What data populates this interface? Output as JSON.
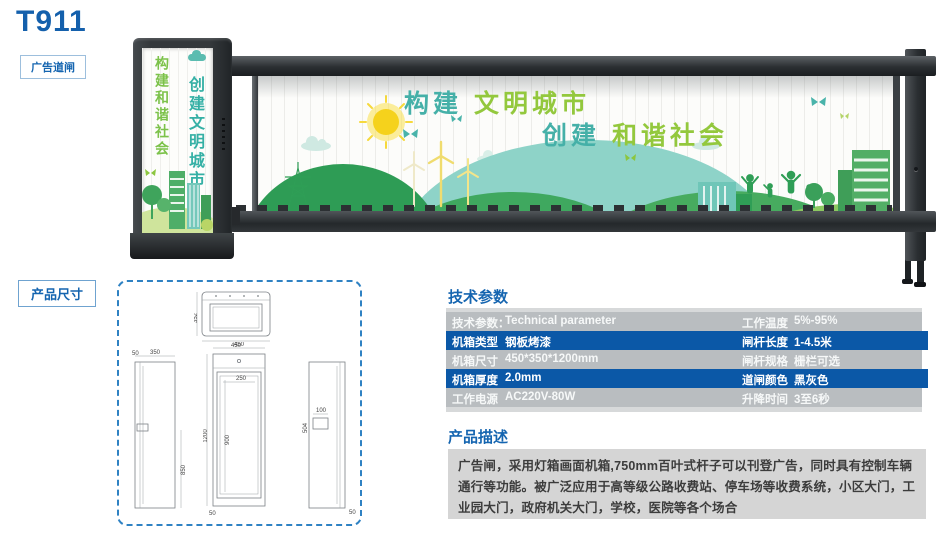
{
  "header": {
    "model": "T911",
    "tag": "广告道闸"
  },
  "figure": {
    "cabinet_col_left": "构建和谐社会",
    "cabinet_col_right": "创建文明城市",
    "banner": {
      "line1_a": "构建",
      "line1_b": "文明城市",
      "line2_a": "创建",
      "line2_b": "和谐社会"
    }
  },
  "dims": {
    "label": "产品尺寸",
    "top_view": {
      "depth": "352",
      "width": "450"
    },
    "side_left": {
      "offset": "50",
      "depth": "350",
      "lower_height": "850"
    },
    "front": {
      "width": "450",
      "height": "1200",
      "inner_height": "900",
      "inner_width": "250",
      "base": "50"
    },
    "side_right": {
      "detail_width": "100",
      "detail_height": "504",
      "base": "50"
    }
  },
  "specs": {
    "title": "技术参数",
    "rows": [
      {
        "ll": "技术参数：",
        "lv": "Technical parameter",
        "rl": "工作温度",
        "rv": "5%-95%"
      },
      {
        "ll": "机箱类型",
        "lv": "钢板烤漆",
        "rl": "闸杆长度",
        "rv": "1-4.5米"
      },
      {
        "ll": "机箱尺寸",
        "lv": "450*350*1200mm",
        "rl": "闸杆规格",
        "rv": "栅栏可选"
      },
      {
        "ll": "机箱厚度",
        "lv": "2.0mm",
        "rl": "道闸颜色",
        "rv": "黑灰色"
      },
      {
        "ll": "工作电源",
        "lv": "AC220V-80W",
        "rl": "升降时间",
        "rv": "3至6秒"
      }
    ]
  },
  "description": {
    "title": "产品描述",
    "text": "广告闸，采用灯箱画面机箱,750mm百叶式杆子可以刊登广告，同时具有控制车辆通行等功能。被广泛应用于高等级公路收费站、停车场等收费系统，小区大门，工业园大门，政府机关大门，学校，医院等各个场合"
  },
  "colors": {
    "accent_blue": "#1565b0",
    "table_blue": "#0b58a7",
    "table_gray": "#b9bdc0",
    "teal": "#45b0a8",
    "green": "#93c83d"
  }
}
